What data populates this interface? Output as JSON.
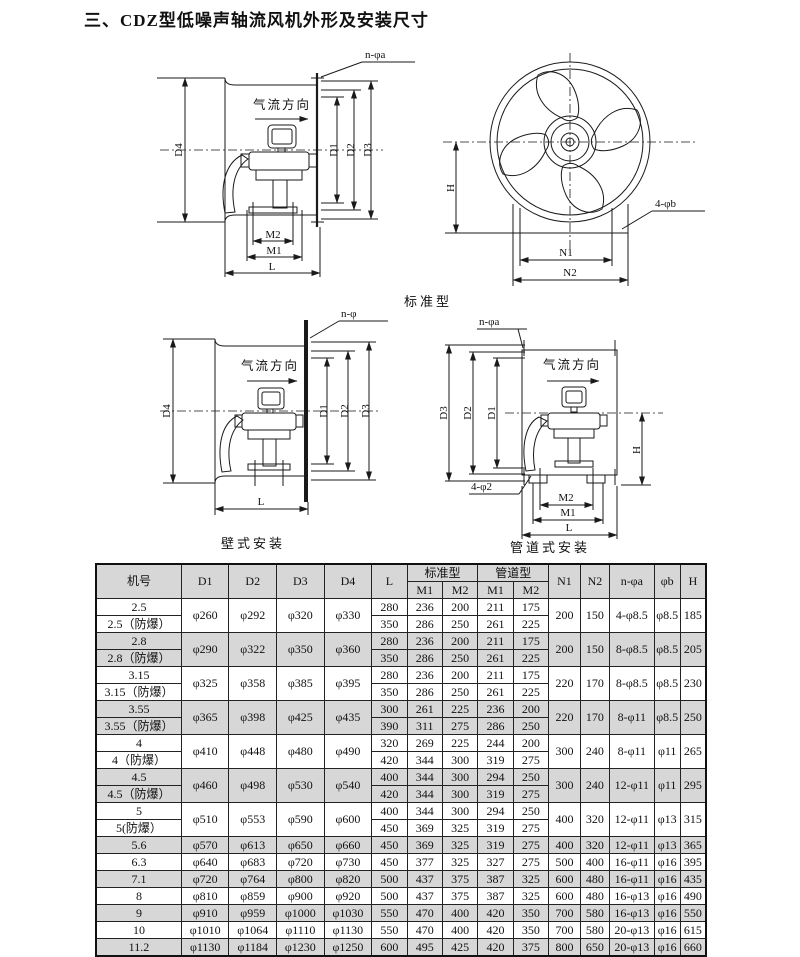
{
  "page": {
    "title": "三、CDZ型低噪声轴流风机外形及安装尺寸"
  },
  "figures": {
    "standard_label": "标准型",
    "wall_caption": "壁式安装",
    "duct_caption": "管道式安装",
    "side": {
      "bolt": "n-φa",
      "airflow": "气流方向",
      "d1": "D1",
      "d2": "D2",
      "d3": "D3",
      "d4": "D4",
      "m1": "M1",
      "m2": "M2",
      "l": "L"
    },
    "front": {
      "h": "H",
      "bolt": "4-φb",
      "n1": "N1",
      "n2": "N2"
    },
    "wall": {
      "bolt": "n-φ",
      "airflow": "气流方向",
      "d1": "D1",
      "d2": "D2",
      "d3": "D3",
      "d4": "D4",
      "l": "L"
    },
    "duct": {
      "bolt_top": "n-φa",
      "bolt_bottom": "4-φ2",
      "airflow": "气流方向",
      "d1": "D1",
      "d2": "D2",
      "d3": "D3",
      "h": "H",
      "m1": "M1",
      "m2": "M2",
      "l": "L"
    }
  },
  "table": {
    "headers": {
      "model": "机号",
      "d1": "D1",
      "d2": "D2",
      "d3": "D3",
      "d4": "D4",
      "l": "L",
      "standard": "标准型",
      "duct": "管道型",
      "m1": "M1",
      "m2": "M2",
      "n1": "N1",
      "n2": "N2",
      "na": "n-φa",
      "pb": "φb",
      "h": "H"
    },
    "groups": [
      {
        "labels": [
          "2.5",
          "2.5（防爆）"
        ],
        "d1": "φ260",
        "d2": "φ292",
        "d3": "φ320",
        "d4": "φ330",
        "l": [
          "280",
          "350"
        ],
        "sm1": [
          "236",
          "286"
        ],
        "sm2": [
          "200",
          "250"
        ],
        "gm1": [
          "211",
          "261"
        ],
        "gm2": [
          "175",
          "225"
        ],
        "n1": "200",
        "n2": "150",
        "na": "4-φ8.5",
        "pb": "φ8.5",
        "h": "185",
        "shaded": false
      },
      {
        "labels": [
          "2.8",
          "2.8（防爆）"
        ],
        "d1": "φ290",
        "d2": "φ322",
        "d3": "φ350",
        "d4": "φ360",
        "l": [
          "280",
          "350"
        ],
        "sm1": [
          "236",
          "286"
        ],
        "sm2": [
          "200",
          "250"
        ],
        "gm1": [
          "211",
          "261"
        ],
        "gm2": [
          "175",
          "225"
        ],
        "n1": "200",
        "n2": "150",
        "na": "8-φ8.5",
        "pb": "φ8.5",
        "h": "205",
        "shaded": true
      },
      {
        "labels": [
          "3.15",
          "3.15（防爆）"
        ],
        "d1": "φ325",
        "d2": "φ358",
        "d3": "φ385",
        "d4": "φ395",
        "l": [
          "280",
          "350"
        ],
        "sm1": [
          "236",
          "286"
        ],
        "sm2": [
          "200",
          "250"
        ],
        "gm1": [
          "211",
          "261"
        ],
        "gm2": [
          "175",
          "225"
        ],
        "n1": "220",
        "n2": "170",
        "na": "8-φ8.5",
        "pb": "φ8.5",
        "h": "230",
        "shaded": false
      },
      {
        "labels": [
          "3.55",
          "3.55（防爆）"
        ],
        "d1": "φ365",
        "d2": "φ398",
        "d3": "φ425",
        "d4": "φ435",
        "l": [
          "300",
          "390"
        ],
        "sm1": [
          "261",
          "311"
        ],
        "sm2": [
          "225",
          "275"
        ],
        "gm1": [
          "236",
          "286"
        ],
        "gm2": [
          "200",
          "250"
        ],
        "n1": "220",
        "n2": "170",
        "na": "8-φ11",
        "pb": "φ8.5",
        "h": "250",
        "shaded": true
      },
      {
        "labels": [
          "4",
          "4（防爆）"
        ],
        "d1": "φ410",
        "d2": "φ448",
        "d3": "φ480",
        "d4": "φ490",
        "l": [
          "320",
          "420"
        ],
        "sm1": [
          "269",
          "344"
        ],
        "sm2": [
          "225",
          "300"
        ],
        "gm1": [
          "244",
          "319"
        ],
        "gm2": [
          "200",
          "275"
        ],
        "n1": "300",
        "n2": "240",
        "na": "8-φ11",
        "pb": "φ11",
        "h": "265",
        "shaded": false
      },
      {
        "labels": [
          "4.5",
          "4.5（防爆）"
        ],
        "d1": "φ460",
        "d2": "φ498",
        "d3": "φ530",
        "d4": "φ540",
        "l": [
          "400",
          "420"
        ],
        "sm1": [
          "344",
          "344"
        ],
        "sm2": [
          "300",
          "300"
        ],
        "gm1": [
          "294",
          "319"
        ],
        "gm2": [
          "250",
          "275"
        ],
        "n1": "300",
        "n2": "240",
        "na": "12-φ11",
        "pb": "φ11",
        "h": "295",
        "shaded": true
      },
      {
        "labels": [
          "5",
          "5(防爆）"
        ],
        "d1": "φ510",
        "d2": "φ553",
        "d3": "φ590",
        "d4": "φ600",
        "l": [
          "400",
          "450"
        ],
        "sm1": [
          "344",
          "369"
        ],
        "sm2": [
          "300",
          "325"
        ],
        "gm1": [
          "294",
          "319"
        ],
        "gm2": [
          "250",
          "275"
        ],
        "n1": "400",
        "n2": "320",
        "na": "12-φ11",
        "pb": "φ13",
        "h": "315",
        "shaded": false
      }
    ],
    "rows": [
      {
        "label": "5.6",
        "d1": "φ570",
        "d2": "φ613",
        "d3": "φ650",
        "d4": "φ660",
        "l": "450",
        "sm1": "369",
        "sm2": "325",
        "gm1": "319",
        "gm2": "275",
        "n1": "400",
        "n2": "320",
        "na": "12-φ11",
        "pb": "φ13",
        "h": "365",
        "shaded": true
      },
      {
        "label": "6.3",
        "d1": "φ640",
        "d2": "φ683",
        "d3": "φ720",
        "d4": "φ730",
        "l": "450",
        "sm1": "377",
        "sm2": "325",
        "gm1": "327",
        "gm2": "275",
        "n1": "500",
        "n2": "400",
        "na": "16-φ11",
        "pb": "φ16",
        "h": "395",
        "shaded": false
      },
      {
        "label": "7.1",
        "d1": "φ720",
        "d2": "φ764",
        "d3": "φ800",
        "d4": "φ820",
        "l": "500",
        "sm1": "437",
        "sm2": "375",
        "gm1": "387",
        "gm2": "325",
        "n1": "600",
        "n2": "480",
        "na": "16-φ11",
        "pb": "φ16",
        "h": "435",
        "shaded": true
      },
      {
        "label": "8",
        "d1": "φ810",
        "d2": "φ859",
        "d3": "φ900",
        "d4": "φ920",
        "l": "500",
        "sm1": "437",
        "sm2": "375",
        "gm1": "387",
        "gm2": "325",
        "n1": "600",
        "n2": "480",
        "na": "16-φ13",
        "pb": "φ16",
        "h": "490",
        "shaded": false
      },
      {
        "label": "9",
        "d1": "φ910",
        "d2": "φ959",
        "d3": "φ1000",
        "d4": "φ1030",
        "l": "550",
        "sm1": "470",
        "sm2": "400",
        "gm1": "420",
        "gm2": "350",
        "n1": "700",
        "n2": "580",
        "na": "16-φ13",
        "pb": "φ16",
        "h": "550",
        "shaded": true
      },
      {
        "label": "10",
        "d1": "φ1010",
        "d2": "φ1064",
        "d3": "φ1110",
        "d4": "φ1130",
        "l": "550",
        "sm1": "470",
        "sm2": "400",
        "gm1": "420",
        "gm2": "350",
        "n1": "700",
        "n2": "580",
        "na": "20-φ13",
        "pb": "φ16",
        "h": "615",
        "shaded": false
      },
      {
        "label": "11.2",
        "d1": "φ1130",
        "d2": "φ1184",
        "d3": "φ1230",
        "d4": "φ1250",
        "l": "600",
        "sm1": "495",
        "sm2": "425",
        "gm1": "420",
        "gm2": "375",
        "n1": "800",
        "n2": "650",
        "na": "20-φ13",
        "pb": "φ16",
        "h": "660",
        "shaded": true
      }
    ]
  }
}
